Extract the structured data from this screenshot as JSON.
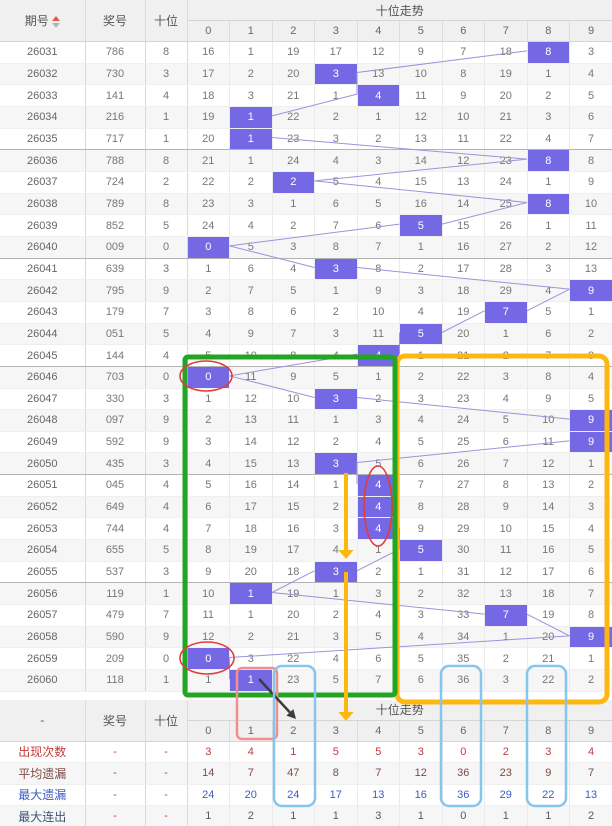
{
  "header": {
    "issue": "期号",
    "prize": "奖号",
    "tens": "十位",
    "trend": "十位走势"
  },
  "summary_header": {
    "issue": "-",
    "prize": "奖号",
    "tens": "十位",
    "trend": "十位走势"
  },
  "trend_columns": [
    "0",
    "1",
    "2",
    "3",
    "4",
    "5",
    "6",
    "7",
    "8",
    "9"
  ],
  "colors": {
    "hit_cell": "#7568e4",
    "trend_line": "#9a94da",
    "green_box": "#23a523",
    "yellow_box": "#fcb810",
    "red_mark": "#e23b3b",
    "salmon_box": "#ef8f8f",
    "blue_box": "#86c5ed",
    "black_arrow": "#3c3c3c"
  },
  "rows": [
    {
      "issue": "26031",
      "prize": "786",
      "tens": "8",
      "hit": 8,
      "cells": [
        "16",
        "1",
        "19",
        "17",
        "12",
        "9",
        "7",
        "18",
        "8",
        "3"
      ]
    },
    {
      "issue": "26032",
      "prize": "730",
      "tens": "3",
      "hit": 3,
      "cells": [
        "17",
        "2",
        "20",
        "3",
        "13",
        "10",
        "8",
        "19",
        "1",
        "4"
      ]
    },
    {
      "issue": "26033",
      "prize": "141",
      "tens": "4",
      "hit": 4,
      "cells": [
        "18",
        "3",
        "21",
        "1",
        "4",
        "11",
        "9",
        "20",
        "2",
        "5"
      ]
    },
    {
      "issue": "26034",
      "prize": "216",
      "tens": "1",
      "hit": 1,
      "cells": [
        "19",
        "1",
        "22",
        "2",
        "1",
        "12",
        "10",
        "21",
        "3",
        "6"
      ]
    },
    {
      "issue": "26035",
      "prize": "717",
      "tens": "1",
      "hit": 1,
      "cells": [
        "20",
        "1",
        "23",
        "3",
        "2",
        "13",
        "11",
        "22",
        "4",
        "7"
      ]
    },
    {
      "issue": "26036",
      "prize": "788",
      "tens": "8",
      "hit": 8,
      "cells": [
        "21",
        "1",
        "24",
        "4",
        "3",
        "14",
        "12",
        "23",
        "8",
        "8"
      ]
    },
    {
      "issue": "26037",
      "prize": "724",
      "tens": "2",
      "hit": 2,
      "cells": [
        "22",
        "2",
        "2",
        "5",
        "4",
        "15",
        "13",
        "24",
        "1",
        "9"
      ]
    },
    {
      "issue": "26038",
      "prize": "789",
      "tens": "8",
      "hit": 8,
      "cells": [
        "23",
        "3",
        "1",
        "6",
        "5",
        "16",
        "14",
        "25",
        "8",
        "10"
      ]
    },
    {
      "issue": "26039",
      "prize": "852",
      "tens": "5",
      "hit": 5,
      "cells": [
        "24",
        "4",
        "2",
        "7",
        "6",
        "5",
        "15",
        "26",
        "1",
        "11"
      ]
    },
    {
      "issue": "26040",
      "prize": "009",
      "tens": "0",
      "hit": 0,
      "cells": [
        "0",
        "5",
        "3",
        "8",
        "7",
        "1",
        "16",
        "27",
        "2",
        "12"
      ]
    },
    {
      "issue": "26041",
      "prize": "639",
      "tens": "3",
      "hit": 3,
      "cells": [
        "1",
        "6",
        "4",
        "3",
        "8",
        "2",
        "17",
        "28",
        "3",
        "13"
      ]
    },
    {
      "issue": "26042",
      "prize": "795",
      "tens": "9",
      "hit": 9,
      "cells": [
        "2",
        "7",
        "5",
        "1",
        "9",
        "3",
        "18",
        "29",
        "4",
        "9"
      ]
    },
    {
      "issue": "26043",
      "prize": "179",
      "tens": "7",
      "hit": 7,
      "cells": [
        "3",
        "8",
        "6",
        "2",
        "10",
        "4",
        "19",
        "7",
        "5",
        "1"
      ]
    },
    {
      "issue": "26044",
      "prize": "051",
      "tens": "5",
      "hit": 5,
      "cells": [
        "4",
        "9",
        "7",
        "3",
        "11",
        "5",
        "20",
        "1",
        "6",
        "2"
      ]
    },
    {
      "issue": "26045",
      "prize": "144",
      "tens": "4",
      "hit": 4,
      "cells": [
        "5",
        "10",
        "8",
        "4",
        "4",
        "1",
        "21",
        "2",
        "7",
        "3"
      ]
    },
    {
      "issue": "26046",
      "prize": "703",
      "tens": "0",
      "hit": 0,
      "cells": [
        "0",
        "11",
        "9",
        "5",
        "1",
        "2",
        "22",
        "3",
        "8",
        "4"
      ]
    },
    {
      "issue": "26047",
      "prize": "330",
      "tens": "3",
      "hit": 3,
      "cells": [
        "1",
        "12",
        "10",
        "3",
        "2",
        "3",
        "23",
        "4",
        "9",
        "5"
      ]
    },
    {
      "issue": "26048",
      "prize": "097",
      "tens": "9",
      "hit": 9,
      "cells": [
        "2",
        "13",
        "11",
        "1",
        "3",
        "4",
        "24",
        "5",
        "10",
        "9"
      ]
    },
    {
      "issue": "26049",
      "prize": "592",
      "tens": "9",
      "hit": 9,
      "cells": [
        "3",
        "14",
        "12",
        "2",
        "4",
        "5",
        "25",
        "6",
        "11",
        "9"
      ]
    },
    {
      "issue": "26050",
      "prize": "435",
      "tens": "3",
      "hit": 3,
      "cells": [
        "4",
        "15",
        "13",
        "3",
        "5",
        "6",
        "26",
        "7",
        "12",
        "1"
      ]
    },
    {
      "issue": "26051",
      "prize": "045",
      "tens": "4",
      "hit": 4,
      "cells": [
        "5",
        "16",
        "14",
        "1",
        "4",
        "7",
        "27",
        "8",
        "13",
        "2"
      ]
    },
    {
      "issue": "26052",
      "prize": "649",
      "tens": "4",
      "hit": 4,
      "cells": [
        "6",
        "17",
        "15",
        "2",
        "4",
        "8",
        "28",
        "9",
        "14",
        "3"
      ]
    },
    {
      "issue": "26053",
      "prize": "744",
      "tens": "4",
      "hit": 4,
      "cells": [
        "7",
        "18",
        "16",
        "3",
        "4",
        "9",
        "29",
        "10",
        "15",
        "4"
      ]
    },
    {
      "issue": "26054",
      "prize": "655",
      "tens": "5",
      "hit": 5,
      "cells": [
        "8",
        "19",
        "17",
        "4",
        "1",
        "5",
        "30",
        "11",
        "16",
        "5"
      ]
    },
    {
      "issue": "26055",
      "prize": "537",
      "tens": "3",
      "hit": 3,
      "cells": [
        "9",
        "20",
        "18",
        "3",
        "2",
        "1",
        "31",
        "12",
        "17",
        "6"
      ]
    },
    {
      "issue": "26056",
      "prize": "119",
      "tens": "1",
      "hit": 1,
      "cells": [
        "10",
        "1",
        "19",
        "1",
        "3",
        "2",
        "32",
        "13",
        "18",
        "7"
      ]
    },
    {
      "issue": "26057",
      "prize": "479",
      "tens": "7",
      "hit": 7,
      "cells": [
        "11",
        "1",
        "20",
        "2",
        "4",
        "3",
        "33",
        "7",
        "19",
        "8"
      ]
    },
    {
      "issue": "26058",
      "prize": "590",
      "tens": "9",
      "hit": 9,
      "cells": [
        "12",
        "2",
        "21",
        "3",
        "5",
        "4",
        "34",
        "1",
        "20",
        "9"
      ]
    },
    {
      "issue": "26059",
      "prize": "209",
      "tens": "0",
      "hit": 0,
      "cells": [
        "0",
        "3",
        "22",
        "4",
        "6",
        "5",
        "35",
        "2",
        "21",
        "1"
      ]
    },
    {
      "issue": "26060",
      "prize": "118",
      "tens": "1",
      "hit": 1,
      "cells": [
        "1",
        "1",
        "23",
        "5",
        "7",
        "6",
        "36",
        "3",
        "22",
        "2"
      ]
    }
  ],
  "summary": {
    "rows": [
      {
        "label": "出现次数",
        "prize": "-",
        "tens": "-",
        "values": [
          "3",
          "4",
          "1",
          "5",
          "5",
          "3",
          "0",
          "2",
          "3",
          "4"
        ]
      },
      {
        "label": "平均遗漏",
        "prize": "-",
        "tens": "-",
        "values": [
          "14",
          "7",
          "47",
          "8",
          "7",
          "12",
          "36",
          "23",
          "9",
          "7"
        ]
      },
      {
        "label": "最大遗漏",
        "prize": "-",
        "tens": "-",
        "values": [
          "24",
          "20",
          "24",
          "17",
          "13",
          "16",
          "36",
          "29",
          "22",
          "13"
        ]
      },
      {
        "label": "最大连出",
        "prize": "-",
        "tens": "-",
        "values": [
          "1",
          "2",
          "1",
          "1",
          "3",
          "1",
          "0",
          "1",
          "1",
          "2"
        ]
      }
    ]
  },
  "annotations": [
    {
      "name": "yellow-highlight-box",
      "type": "rect",
      "x": 397,
      "y": 356,
      "w": 210,
      "h": 346,
      "rx": 8,
      "color": "#fcb810",
      "stroke_width": 5
    },
    {
      "name": "green-highlight-box",
      "type": "rect",
      "x": 185,
      "y": 357,
      "w": 210,
      "h": 338,
      "rx": 3,
      "color": "#23a523",
      "stroke_width": 5
    },
    {
      "name": "yellow-arrow-upper",
      "type": "arrow",
      "x1": 346,
      "y1": 473,
      "x2": 346,
      "y2": 559,
      "color": "#fcb810",
      "stroke_width": 4
    },
    {
      "name": "yellow-arrow-lower",
      "type": "arrow",
      "x1": 346,
      "y1": 572,
      "x2": 346,
      "y2": 721,
      "color": "#fcb810",
      "stroke_width": 4
    },
    {
      "name": "red-circle-26046",
      "type": "ellipse",
      "cx": 206,
      "cy": 376,
      "rx": 26,
      "ry": 15,
      "color": "#e23b3b",
      "stroke_width": 1.6
    },
    {
      "name": "red-circle-26051-26053",
      "type": "ellipse",
      "cx": 378,
      "cy": 506,
      "rx": 14,
      "ry": 40,
      "color": "#e23b3b",
      "stroke_width": 1.6
    },
    {
      "name": "red-circle-26059",
      "type": "ellipse",
      "cx": 207,
      "cy": 658,
      "rx": 27,
      "ry": 16,
      "color": "#e23b3b",
      "stroke_width": 1.6
    },
    {
      "name": "red-box-column1",
      "type": "rect",
      "x": 237,
      "y": 668,
      "w": 40,
      "h": 71,
      "rx": 5,
      "color": "#ef8f8f",
      "stroke_width": 2.5
    },
    {
      "name": "black-arrow",
      "type": "arrow",
      "x1": 259,
      "y1": 679,
      "x2": 296,
      "y2": 719,
      "color": "#3c3c3c",
      "stroke_width": 2.5
    },
    {
      "name": "blue-box-column2",
      "type": "rect",
      "x": 274,
      "y": 666,
      "w": 41,
      "h": 140,
      "rx": 8,
      "color": "#86c5ed",
      "stroke_width": 2.5
    },
    {
      "name": "blue-box-column6",
      "type": "rect",
      "x": 441,
      "y": 666,
      "w": 40,
      "h": 140,
      "rx": 8,
      "color": "#86c5ed",
      "stroke_width": 2.5
    },
    {
      "name": "blue-box-column8",
      "type": "rect",
      "x": 527,
      "y": 666,
      "w": 39,
      "h": 140,
      "rx": 8,
      "color": "#86c5ed",
      "stroke_width": 2.5
    }
  ]
}
